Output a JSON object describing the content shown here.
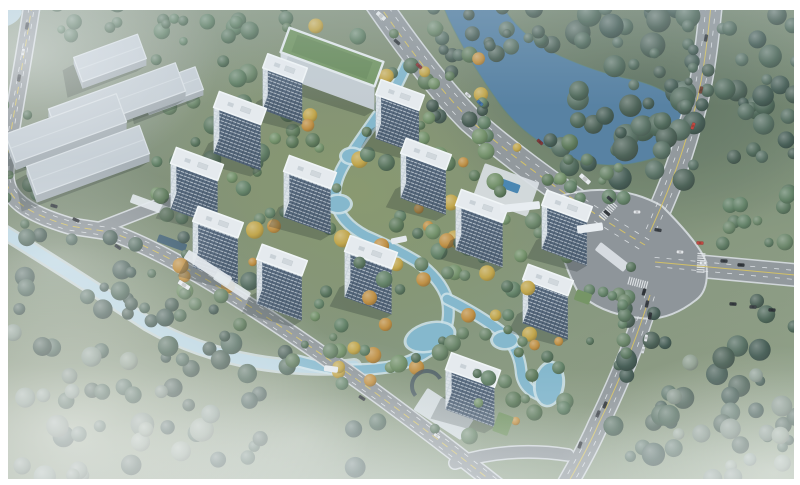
{
  "title": "Aerial masterplan rendering of a riverside residential development with thirteen white towers, a green-roof amenity building, warehouses, perimeter roads and landscaped waterways",
  "palette": {
    "grass_base": "#7f8f76",
    "grass_site": "#8c9a5e",
    "forest_dark": "#3c544a",
    "water_river": "#4d7a9d",
    "water_stream": "#7fb6cc",
    "water_stream_shore": "#cde2e9",
    "water_canal": "#b9d6e4",
    "water_canal_shore": "#dfeaf0",
    "road_fill": "#8e9397",
    "road_casing": "#d3d7da",
    "intersection_fill": "#8a8f94",
    "line_yellow": "#d9c257",
    "line_white": "#eceff1",
    "tower_roof": "#eaeef1",
    "tower_roof_edge": "#f7fafb",
    "tower_front_base": "#4d6077",
    "tower_front_mullion": "#394a5e",
    "tower_floor_band": "#c7d0d9",
    "tower_side": "#dfe5ea",
    "warehouse_roof": "#c7cfd5",
    "warehouse_front": "#a6aeb4",
    "warehouse_side": "#b6bec4",
    "green_roof": "#6f925c",
    "green_roof_inner": "#648753",
    "paving": "#e7ebee",
    "pool_blue": "#3f7fae",
    "shadow": "rgba(22,32,28,0.27)"
  },
  "tree_palettes": {
    "dark": [
      "#3c544a",
      "#46604f",
      "#50695a",
      "#42584b"
    ],
    "mid": [
      "#4e6a50",
      "#5a7a5c",
      "#637f5f",
      "#557257"
    ],
    "bank": [
      "#42584e",
      "#4d6557",
      "#3e5348"
    ],
    "hazy": [
      "#78897b",
      "#86978a",
      "#8d9c8b"
    ],
    "site": [
      "#4e6a50",
      "#5a7a5c",
      "#c2a23e",
      "#637f5f",
      "#c08a36",
      "#55724f",
      "#6b8a5e"
    ]
  },
  "water": {
    "river_path": "M438,-6 L496,-6 Q512,28 548,50 Q592,72 634,80 Q682,92 686,120 Q688,148 648,160 Q606,172 566,156 Q520,136 494,96 Q466,56 448,18 Z",
    "nw_pond": {
      "cx": 8,
      "cy": 16,
      "rx": 15,
      "ry": 9,
      "rot": -30
    },
    "stream_path": "M411,55 Q398,84 387,103 Q366,132 352,153 Q333,178 335,199 Q339,222 366,236 Q396,249 416,261 Q441,279 447,299 Q452,323 439,343 Q419,361 389,367 Q355,372 329,368 Q312,365 298,361",
    "stream_spur": "M447,299 Q478,314 503,333 Q519,349 521,370 Q522,390 543,396",
    "canal_path": "M-6,226 Q60,266 148,324 Q214,362 300,367 Q332,369 354,366",
    "ponds": [
      [
        352,
        156,
        10,
        7,
        0
      ],
      [
        338,
        204,
        12,
        8,
        0
      ],
      [
        430,
        337,
        24,
        13,
        -15
      ],
      [
        505,
        340,
        12,
        8,
        0
      ],
      [
        549,
        384,
        13,
        21,
        8
      ]
    ]
  },
  "roads": {
    "segments": [
      {
        "id": "west-perimeter",
        "d": "M34,-8 C24,60 10,130 6,168 C2,200 30,214 70,226 L110,232 C200,262 380,392 505,492",
        "w": 15,
        "yellow": "dash",
        "white": [
          [
            -3.2,
            3.8
          ],
          [
            3.2,
            -3.8
          ]
        ]
      },
      {
        "id": "west-entrance-stub",
        "d": "M100,228 L172,200",
        "w": 11
      },
      {
        "id": "north-boulevard",
        "d": "M370,-8 Q430,80 470,120 Q545,185 645,245",
        "w": 24,
        "yellow": "dash",
        "white": [
          [
            -5,
            4.5
          ],
          [
            5,
            -4.5
          ]
        ]
      },
      {
        "id": "east-avenue-north",
        "d": "M712,-6 C706,60 700,95 690,125 C678,170 662,205 650,232",
        "w": 21,
        "yellow": "solid",
        "white": [
          [
            -4.8,
            -0.8
          ],
          [
            4.8,
            0.8
          ]
        ]
      },
      {
        "id": "east-arm",
        "d": "M655,262 L806,276",
        "w": 21,
        "yellow": "solid",
        "white": [
          [
            -0.4,
            -4.6
          ],
          [
            0.4,
            4.6
          ]
        ]
      },
      {
        "id": "south-arm",
        "d": "M650,295 C635,345 615,390 598,425 C585,455 572,475 563,492",
        "w": 19,
        "yellow": "solid",
        "white": [
          [
            -4.4,
            -1.6
          ],
          [
            4.4,
            1.6
          ]
        ]
      },
      {
        "id": "south-connector",
        "d": "M455,463 Q510,446 568,455",
        "w": 11
      }
    ],
    "intersection_path": "M560,196 Q615,180 662,206 Q700,244 706,262 Q710,290 696,300 Q668,322 640,318 Q600,314 578,292 Q550,240 560,196 Z",
    "crosswalks": [
      [
        608,
        211,
        42
      ],
      [
        701,
        263,
        3
      ],
      [
        638,
        283,
        -75
      ]
    ]
  },
  "buildings": {
    "warehouses": [
      {
        "cx": 110,
        "cy": 58,
        "w": 68,
        "d": 26,
        "fh": 7,
        "rot": -20
      },
      {
        "cx": 117,
        "cy": 100,
        "w": 135,
        "d": 30,
        "fh": 8,
        "rot": -20
      },
      {
        "cx": 172,
        "cy": 88,
        "w": 58,
        "d": 24,
        "fh": 6,
        "rot": -20
      },
      {
        "cx": 66,
        "cy": 128,
        "w": 118,
        "d": 30,
        "fh": 8,
        "rot": -20
      },
      {
        "cx": 88,
        "cy": 160,
        "w": 120,
        "d": 30,
        "fh": 8,
        "rot": -20
      }
    ],
    "amenity_green_roof": {
      "cx": 332,
      "cy": 57,
      "w": 100,
      "d": 26,
      "fh": 24,
      "rot": 20
    },
    "towers": [
      {
        "cx": 240,
        "cy": 108,
        "w": 50,
        "d": 17,
        "fh": 46
      },
      {
        "cx": 285,
        "cy": 68,
        "w": 42,
        "d": 15,
        "fh": 42
      },
      {
        "cx": 400,
        "cy": 95,
        "w": 46,
        "d": 16,
        "fh": 44
      },
      {
        "cx": 197,
        "cy": 164,
        "w": 50,
        "d": 17,
        "fh": 46
      },
      {
        "cx": 310,
        "cy": 172,
        "w": 50,
        "d": 17,
        "fh": 46
      },
      {
        "cx": 426,
        "cy": 154,
        "w": 48,
        "d": 16,
        "fh": 45
      },
      {
        "cx": 218,
        "cy": 222,
        "w": 48,
        "d": 16,
        "fh": 46
      },
      {
        "cx": 282,
        "cy": 260,
        "w": 48,
        "d": 16,
        "fh": 45
      },
      {
        "cx": 371,
        "cy": 252,
        "w": 50,
        "d": 17,
        "fh": 46
      },
      {
        "cx": 482,
        "cy": 206,
        "w": 50,
        "d": 17,
        "fh": 45
      },
      {
        "cx": 567,
        "cy": 206,
        "w": 48,
        "d": 16,
        "fh": 44
      },
      {
        "cx": 548,
        "cy": 280,
        "w": 48,
        "d": 16,
        "fh": 44
      },
      {
        "cx": 473,
        "cy": 370,
        "w": 52,
        "d": 18,
        "fh": 40
      }
    ],
    "tower_rot": 20
  },
  "tree_belts": [
    {
      "x": 545,
      "y": 2,
      "w": 150,
      "h": 180,
      "n": 55,
      "rmin": 5,
      "rmax": 13,
      "pal": "dark",
      "seed": 1
    },
    {
      "x": 488,
      "y": 2,
      "w": 58,
      "h": 52,
      "n": 14,
      "rmin": 4,
      "rmax": 9,
      "pal": "dark",
      "seed": 2
    },
    {
      "x": 722,
      "y": 2,
      "w": 74,
      "h": 205,
      "n": 26,
      "rmin": 5,
      "rmax": 12,
      "pal": "dark",
      "seed": 3
    },
    {
      "x": 688,
      "y": 8,
      "w": 22,
      "h": 100,
      "n": 8,
      "rmin": 3,
      "rmax": 7,
      "pal": "dark",
      "seed": 4
    },
    {
      "x": 700,
      "y": 192,
      "w": 95,
      "h": 58,
      "n": 12,
      "rmin": 4,
      "rmax": 9,
      "pal": "mid",
      "seed": 5
    },
    {
      "x": 612,
      "y": 300,
      "w": 185,
      "h": 160,
      "n": 40,
      "rmin": 5,
      "rmax": 12,
      "pal": "dark",
      "seed": 6
    },
    {
      "x": 432,
      "y": 8,
      "w": 60,
      "h": 115,
      "n": 14,
      "rmin": 4,
      "rmax": 8,
      "pal": "bank",
      "seed": 7
    },
    {
      "x": 552,
      "y": 158,
      "w": 95,
      "h": 45,
      "n": 11,
      "rmin": 4,
      "rmax": 8,
      "pal": "mid",
      "seed": 8
    },
    {
      "x": 55,
      "y": 2,
      "w": 240,
      "h": 40,
      "n": 16,
      "rmin": 4,
      "rmax": 9,
      "pal": "mid",
      "seed": 9
    },
    {
      "x": 148,
      "y": 18,
      "w": 120,
      "h": 145,
      "n": 26,
      "rmin": 4,
      "rmax": 10,
      "pal": "mid",
      "seed": 10
    },
    {
      "x": 0,
      "y": 95,
      "w": 40,
      "h": 130,
      "n": 10,
      "rmin": 4,
      "rmax": 8,
      "pal": "mid",
      "seed": 11
    },
    {
      "x": 0,
      "y": 235,
      "w": 320,
      "h": 175,
      "n": 30,
      "rmin": 4,
      "rmax": 10,
      "pal": "bank",
      "seed": 12
    },
    {
      "x": 60,
      "y": 270,
      "w": 400,
      "h": 200,
      "n": 48,
      "rmin": 5,
      "rmax": 11,
      "pal": "dark",
      "seed": 13,
      "below_road": true
    },
    {
      "x": 0,
      "y": 330,
      "w": 250,
      "h": 150,
      "n": 20,
      "rmin": 5,
      "rmax": 12,
      "pal": "hazy",
      "seed": 14
    },
    {
      "x": 640,
      "y": 360,
      "w": 155,
      "h": 120,
      "n": 14,
      "rmin": 5,
      "rmax": 11,
      "pal": "hazy",
      "seed": 15
    },
    {
      "x": 275,
      "y": 25,
      "w": 240,
      "h": 115,
      "n": 30,
      "rmin": 4,
      "rmax": 9,
      "pal": "site",
      "seed": 16
    },
    {
      "x": 245,
      "y": 115,
      "w": 230,
      "h": 150,
      "n": 46,
      "rmin": 4,
      "rmax": 9,
      "pal": "site",
      "seed": 17
    },
    {
      "x": 430,
      "y": 140,
      "w": 140,
      "h": 120,
      "n": 26,
      "rmin": 4,
      "rmax": 9,
      "pal": "site",
      "seed": 18
    },
    {
      "x": 290,
      "y": 255,
      "w": 240,
      "h": 130,
      "n": 40,
      "rmin": 4,
      "rmax": 9,
      "pal": "site",
      "seed": 19,
      "front": true
    },
    {
      "x": 150,
      "y": 165,
      "w": 110,
      "h": 160,
      "n": 24,
      "rmin": 4,
      "rmax": 9,
      "pal": "site",
      "seed": 20
    },
    {
      "x": 415,
      "y": 330,
      "w": 150,
      "h": 115,
      "n": 24,
      "rmin": 4,
      "rmax": 9,
      "pal": "site",
      "seed": 21,
      "front": true
    },
    {
      "x": 585,
      "y": 262,
      "w": 46,
      "h": 95,
      "n": 13,
      "rmin": 4,
      "rmax": 8,
      "pal": "mid",
      "seed": 22,
      "front": true
    }
  ],
  "plazas": [
    [
      506,
      190,
      58,
      36,
      20,
      "#dde2e6",
      0.92
    ],
    [
      507,
      185,
      26,
      9,
      20,
      "#3f7fae",
      1
    ],
    [
      150,
      205,
      40,
      9,
      20,
      "#e7ebee",
      0.9
    ],
    [
      172,
      243,
      30,
      8,
      20,
      "#3a5a6e",
      1
    ],
    [
      444,
      414,
      56,
      26,
      33,
      "#d9dfe4",
      0.95
    ],
    [
      612,
      257,
      36,
      10,
      38,
      "#e7ebee",
      0.85
    ]
  ],
  "front_structures": [
    [
      208,
      268,
      52,
      10,
      33,
      "#e7ebee",
      0.95
    ],
    [
      232,
      286,
      40,
      9,
      33,
      "#e7ebee",
      0.9
    ],
    [
      590,
      228,
      26,
      8,
      -8,
      "#eef1f4",
      1
    ],
    [
      520,
      207,
      40,
      8,
      -6,
      "#eef1f4",
      1
    ],
    [
      583,
      297,
      16,
      11,
      20,
      "#6f8f5a",
      1
    ],
    [
      503,
      424,
      16,
      20,
      20,
      "#6f8f5a",
      1
    ],
    [
      399,
      240,
      16,
      6,
      -12,
      "#e9edf0",
      1
    ],
    [
      331,
      369,
      14,
      6,
      8,
      "#e9edf0",
      1
    ]
  ],
  "round_pavilion": {
    "cx": 427,
    "cy": 386,
    "r": 15
  },
  "cars": [
    [
      381,
      16,
      42,
      "#e9ebec",
      11
    ],
    [
      397,
      42,
      42,
      "#2e3338"
    ],
    [
      419,
      66,
      42,
      "#8a2f2f"
    ],
    [
      468,
      95,
      42,
      "#e4e6e8"
    ],
    [
      480,
      103,
      42,
      "#3a6ea8"
    ],
    [
      540,
      142,
      42,
      "#7a2a2a"
    ],
    [
      585,
      179,
      42,
      "#eef0f2",
      13
    ],
    [
      610,
      199,
      42,
      "#2e3338"
    ],
    [
      706,
      38,
      -80,
      "#2e3338"
    ],
    [
      701,
      90,
      -76,
      "#6e3a2a"
    ],
    [
      693,
      126,
      -70,
      "#c23a30"
    ],
    [
      27,
      26,
      -80,
      "#2e3338"
    ],
    [
      23,
      52,
      -80,
      "#e6e8ea"
    ],
    [
      19,
      78,
      -80,
      "#33373c"
    ],
    [
      54,
      206,
      16,
      "#2e3338"
    ],
    [
      76,
      220,
      25,
      "#24282c"
    ],
    [
      118,
      247,
      33,
      "#2e3338"
    ],
    [
      184,
      285,
      33,
      "#eef0f2",
      13
    ],
    [
      362,
      398,
      33,
      "#24282c"
    ],
    [
      437,
      436,
      33,
      "#e6e8ea"
    ],
    [
      607,
      213,
      40,
      "#2a2e33"
    ],
    [
      637,
      212,
      0,
      "#e8eaec"
    ],
    [
      658,
      230,
      10,
      "#2e3338"
    ],
    [
      700,
      243,
      3,
      "#c23a30"
    ],
    [
      680,
      252,
      3,
      "#e8eaec"
    ],
    [
      703,
      263,
      3,
      "#eceff1"
    ],
    [
      644,
      292,
      -75,
      "#24282c"
    ],
    [
      647,
      304,
      -77,
      "#2e3338"
    ],
    [
      650,
      316,
      -80,
      "#24282c"
    ],
    [
      646,
      338,
      -80,
      "#e8eaec"
    ],
    [
      643,
      350,
      -78,
      "#dfe3e6"
    ],
    [
      605,
      405,
      -68,
      "#24282c"
    ],
    [
      598,
      414,
      -68,
      "#3a3e44"
    ],
    [
      580,
      445,
      -70,
      "#24282c"
    ],
    [
      724,
      261,
      3,
      "#2e3338"
    ],
    [
      741,
      265,
      3,
      "#24282c"
    ],
    [
      733,
      304,
      3,
      "#282c30"
    ],
    [
      753,
      307,
      3,
      "#34383c"
    ],
    [
      772,
      310,
      3,
      "#24282c"
    ]
  ],
  "frame": {
    "top": 10,
    "left": 8,
    "right": 6,
    "bottom": 6,
    "color": "#ffffff"
  }
}
